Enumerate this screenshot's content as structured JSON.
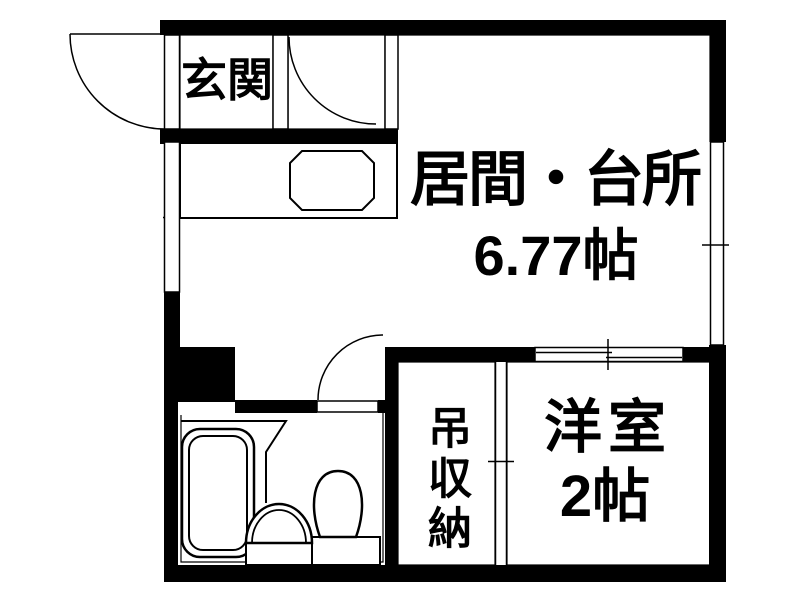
{
  "plan": {
    "rooms": {
      "genkan": {
        "label": "玄関"
      },
      "ldk": {
        "label": "居間・台所",
        "area": "6.77帖"
      },
      "storage": {
        "label": "吊収納"
      },
      "western": {
        "label": "洋室",
        "area": "2帖"
      }
    },
    "fixtures": {
      "bathtub": "bathtub",
      "washbasin": "washbasin",
      "toilet": "toilet",
      "kitchen_sink": "kitchen-sink",
      "kitchen_counter": "kitchen-counter"
    },
    "colors": {
      "wall": "#000000",
      "background": "#ffffff",
      "line": "#000000"
    }
  }
}
